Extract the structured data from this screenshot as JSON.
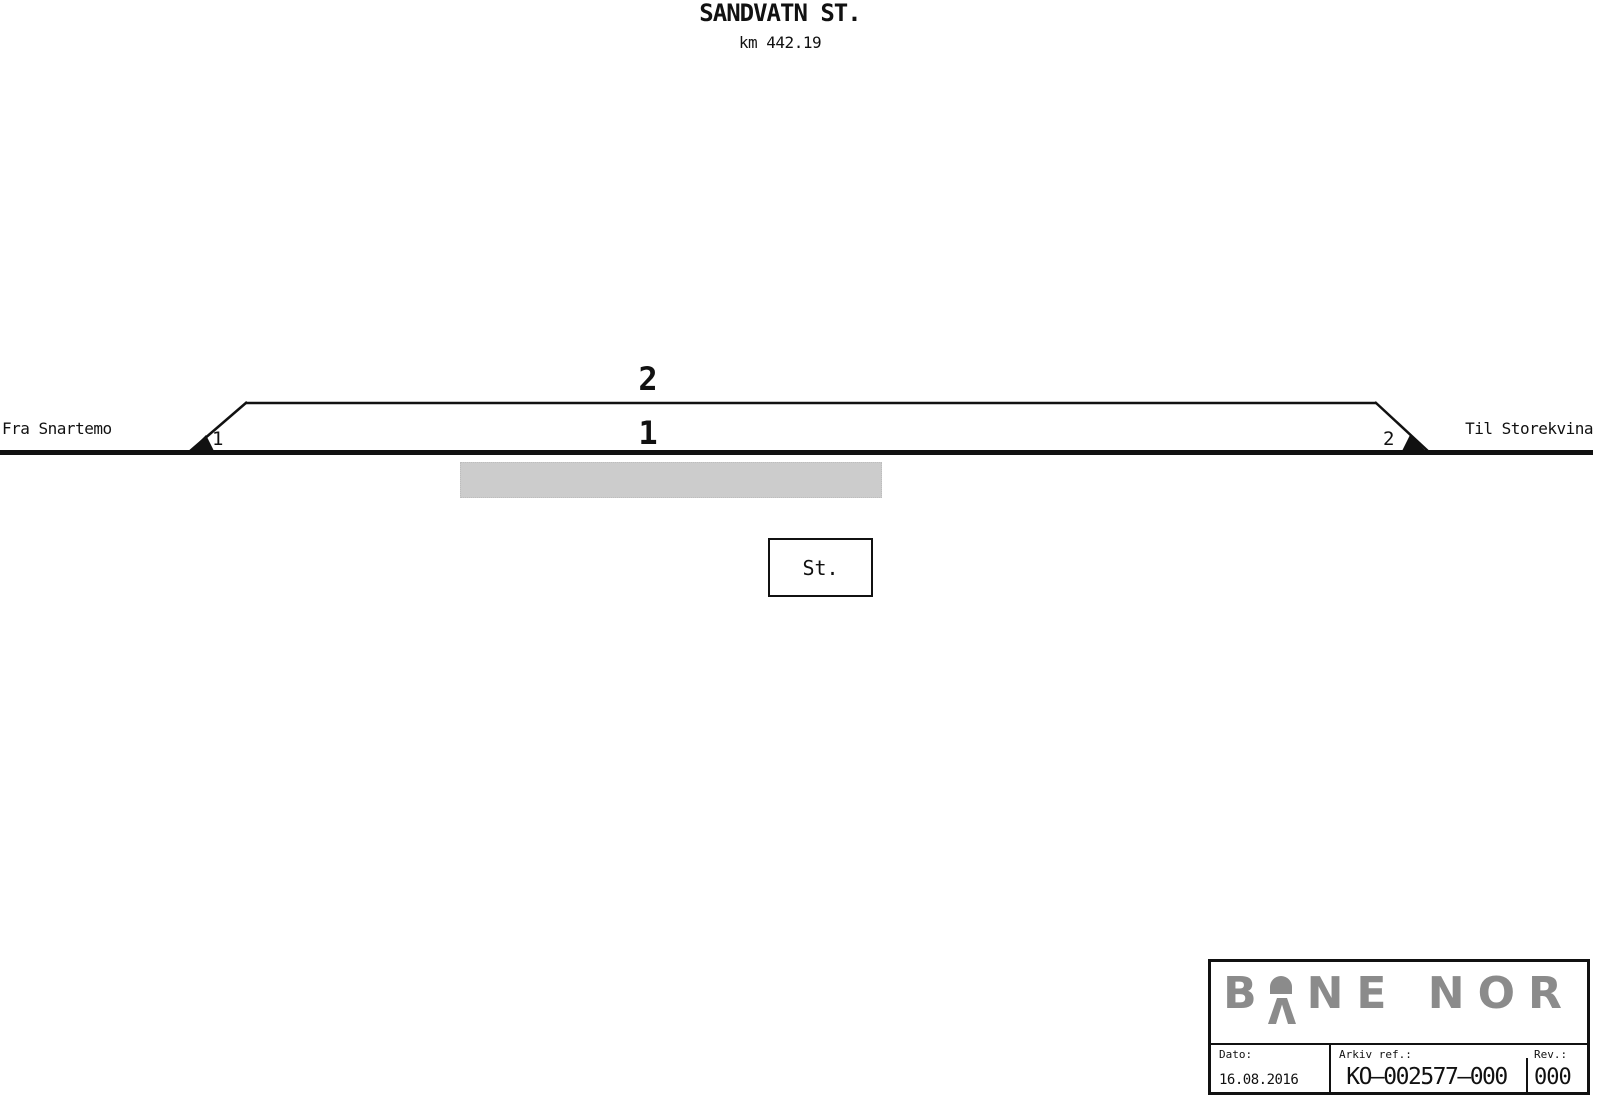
{
  "header": {
    "station_name": "SANDVATN ST.",
    "km": "km 442.19"
  },
  "diagram": {
    "left_label": "Fra Snartemo",
    "right_label": "Til Storekvina",
    "track_2_label": "2",
    "track_1_label": "1",
    "switch_1_label": "1",
    "switch_2_label": "2",
    "station_building_label": "St."
  },
  "title_block": {
    "logo_text_left": "B",
    "logo_text_right": "NE NOR",
    "date_label": "Dato:",
    "date_value": "16.08.2016",
    "archive_label": "Arkiv ref.:",
    "archive_value": "KO–002577–000",
    "rev_label": "Rev.:",
    "rev_value": "000"
  },
  "colors": {
    "ink": "#111111",
    "logo_gray": "#8b8b8b",
    "platform_gray": "#cccccc"
  }
}
